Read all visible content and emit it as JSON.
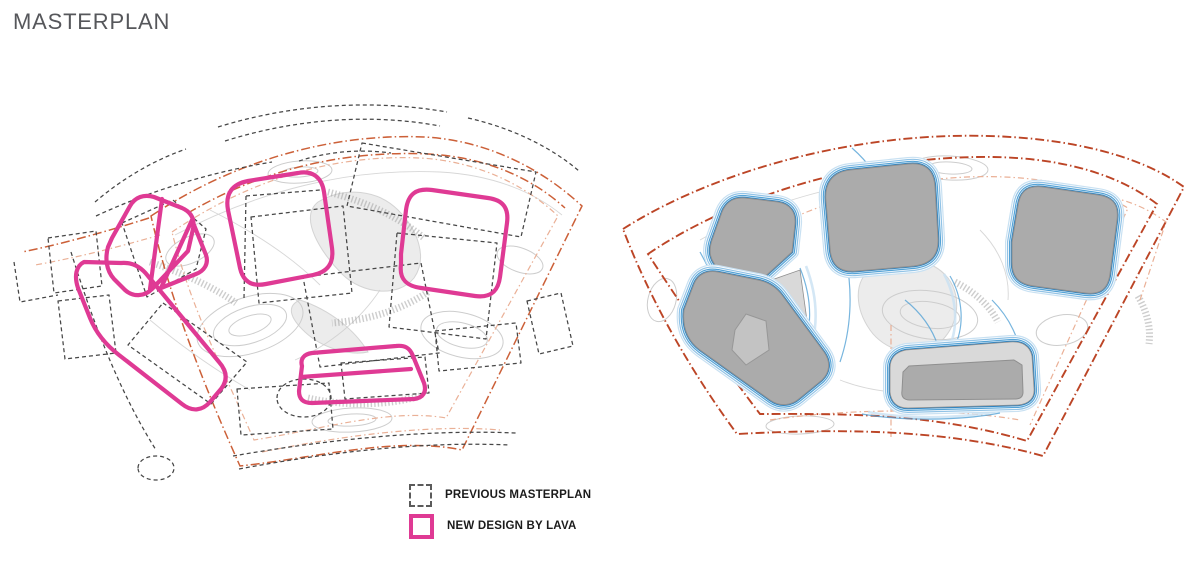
{
  "page": {
    "title": "MASTERPLAN"
  },
  "legend": {
    "items": [
      {
        "label": "PREVIOUS MASTERPLAN",
        "swatch_icon": "dashed-square-icon"
      },
      {
        "label": "NEW DESIGN BY LAVA",
        "swatch_icon": "pink-outline-square-icon"
      }
    ]
  },
  "colors": {
    "title_gray": "#56575B",
    "label_black": "#1B1B1B",
    "new_design_pink": "#DF3A94",
    "prev_dash_gray": "#464646",
    "boundary_orange": "#CC6038",
    "boundary_orange_strong": "#BC4526",
    "boundary_salmon": "#E9AC90",
    "contour_gray": "#CDCDCD",
    "contour_shade": "#E9E9E9",
    "building_gray": "#ABABAB",
    "building_gray_light": "#D9D9D9",
    "building_stroke": "#8F8F8F",
    "blue_pale": "#C9E1F2",
    "blue_light": "#92C3E6",
    "blue_mid": "#55A3D6",
    "blue_strong": "#2B84C4"
  }
}
